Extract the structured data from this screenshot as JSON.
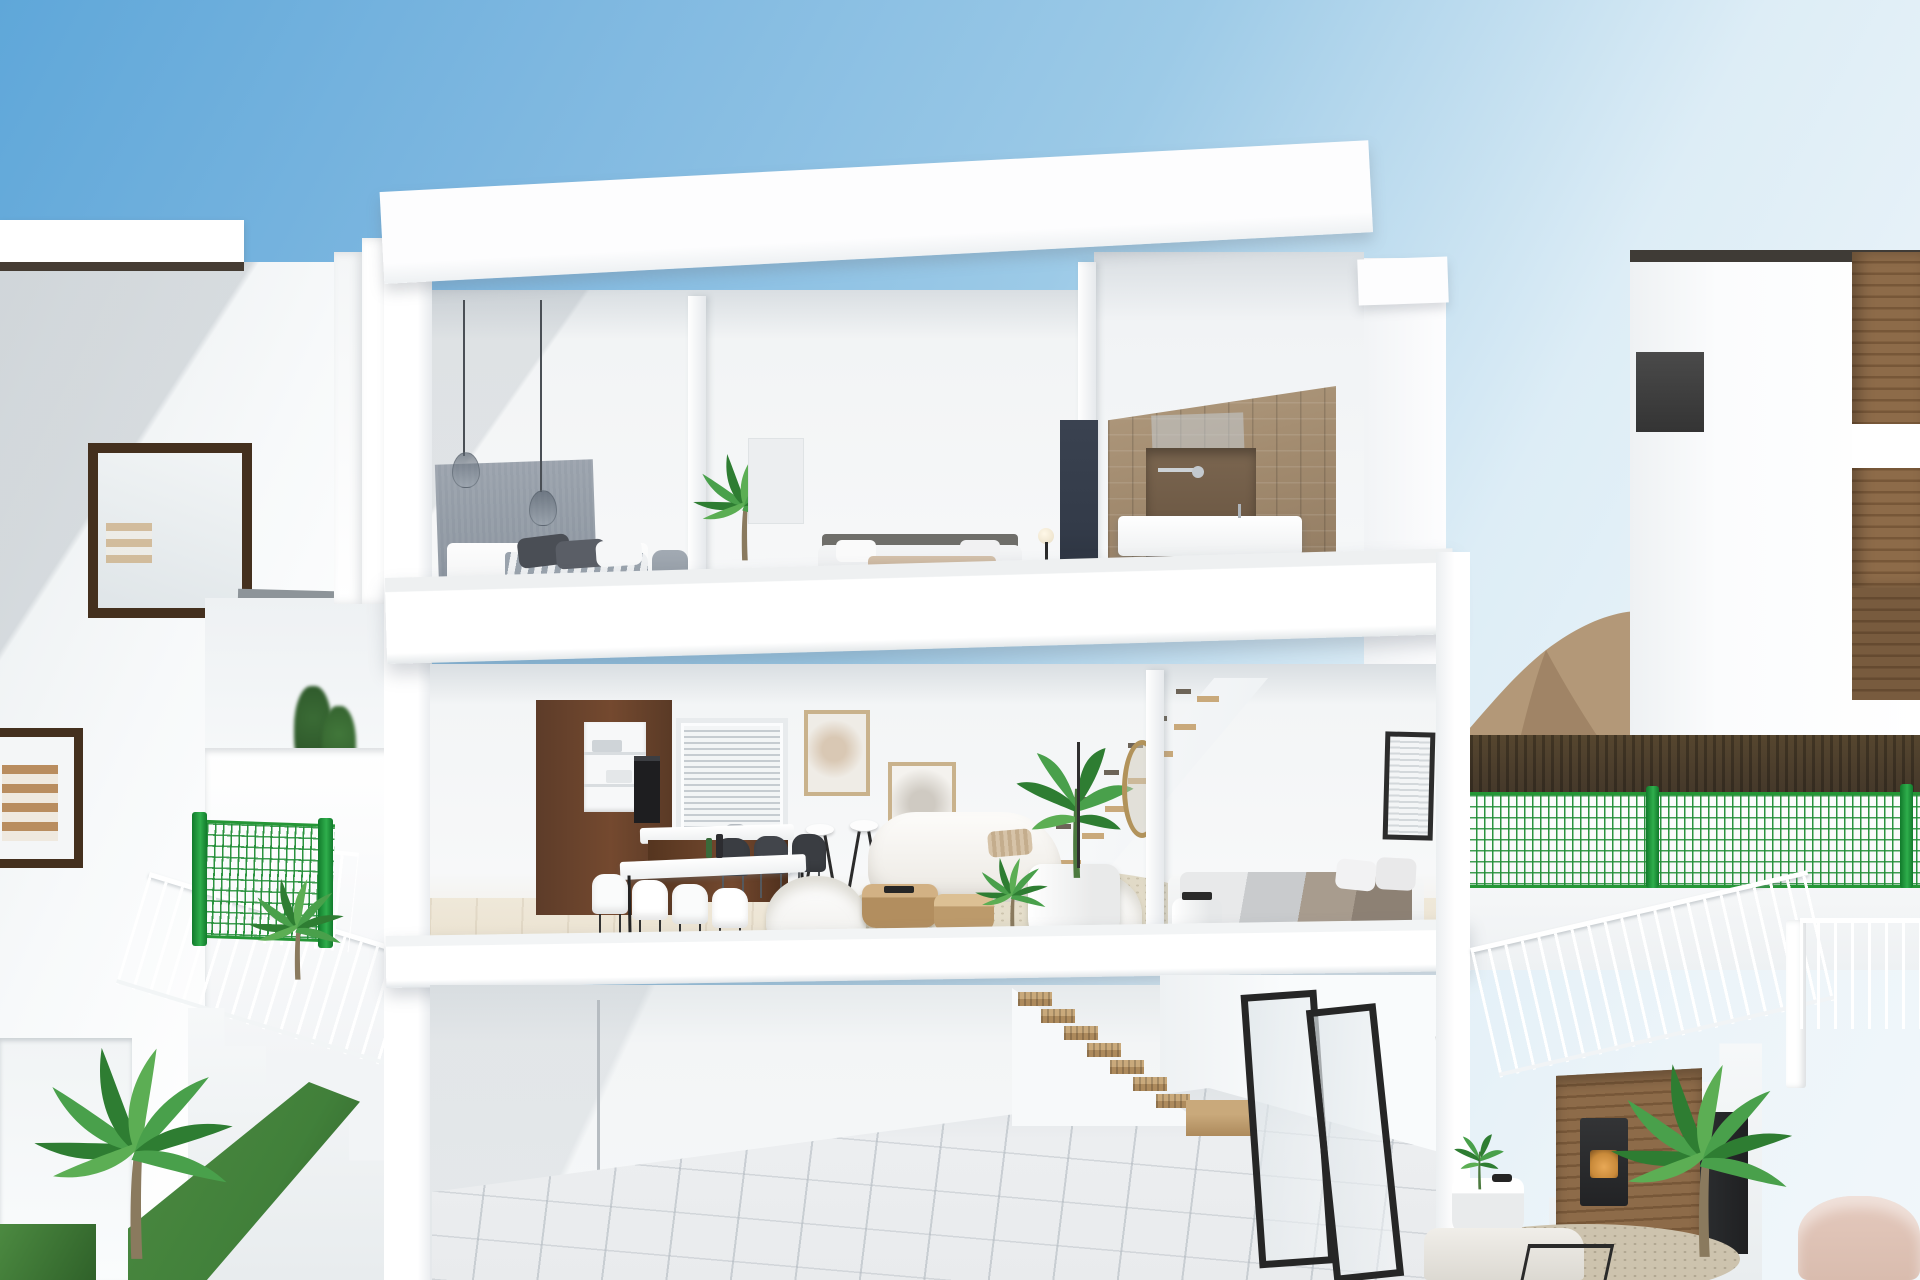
{
  "image": {
    "width": 1920,
    "height": 1280,
    "kind": "3D architectural render, no visible text"
  },
  "scene": {
    "subject": "Cutaway cross-section rendering of a modern three-storey white villa between two neighbouring white houses under a clear blue sky",
    "sky": "clear blue, deepest at upper left, paling toward the horizon",
    "background_elements": [
      "rocky tan mountain slope with green scrub at the right horizon",
      "dark hedge line below the mountains",
      "neighbouring white villa at left with dark-framed windows and interior stair visible",
      "neighbouring white villa at right with dark timber cladding tower and chimney"
    ],
    "floors": [
      {
        "name": "top floor",
        "rooms": [
          "bedroom with grey fabric headboard wall, two glass pendant lamps and striped duvet bed",
          "second bedroom with low bed, beige foot bench, globe floor lamp and tall indoor palm",
          "bathroom with tan stone tiling, dark walk-in shower, chrome fittings, white vanity and navy partition panel"
        ]
      },
      {
        "name": "main floor",
        "rooms": [
          "kitchen with dark walnut cabinetry, white shelf niches, built-in oven, window with venetian blinds and island with bar stools",
          "dining area with white table, white shell chairs and black shell chairs",
          "living room with curved white sofa, two white barrel armchairs, round timber coffee tables, circular beige rug, potted banana plant, gold oval mirror and slim floor lamp",
          "open staircase with floating timber treads rising along the wall",
          "rear bedroom with grey and taupe layered bedding, white laundry cylinder and small blinded window"
        ]
      },
      {
        "name": "basement garage",
        "rooms": [
          "large open space with pale tiled floor",
          "timber staircase with landing block",
          "black-framed glass doors along the rear wall"
        ]
      }
    ],
    "exterior_elements": [
      "green wire-mesh garden fences with round green posts",
      "white outdoor staircases with slender white balustrades on both sides",
      "palm plants, ornamental grass strips and small dark shrubs",
      "outdoor lounge with timber slat wall, black stove with amber glow, tall dark cabinet, round white side table, pale sofa and blush armchair"
    ]
  },
  "colors": {
    "sky1": "#5fa7d9",
    "sky2": "#9ccae7",
    "sky3": "#ddedf6",
    "white": "#ffffff",
    "shade1": "#f4f6f7",
    "shade2": "#e9edef",
    "shade3": "#d9dee2",
    "shade4": "#c6cdd3",
    "walnut1": "#5d3c29",
    "walnut2": "#74492f",
    "walnutDark": "#3f2818",
    "navy": "#333b49",
    "tileTan": "#a18a6e",
    "showerBrown": "#6e593f",
    "gold": "#b2935b",
    "headGrey": "#89929d",
    "pillowDark": "#4a4e55",
    "chairDark": "#3a3d42",
    "woodLight": "#c9a97b",
    "woodMid": "#ad8a5c",
    "rugBeige": "#ded7c4",
    "floorWood": "#efe8d9",
    "tileFloor": "#e9ebed",
    "green1": "#2e7d32",
    "green2": "#49a04b",
    "green3": "#5cae54",
    "fenceGreen": "#259636",
    "fencePost": "#117a2b",
    "grass": "#41803a",
    "mountain1": "#b39878",
    "mountain2": "#8f7557",
    "mountainGreen": "#6d7d4f",
    "hedge": "#44382a",
    "frameBrown": "#44301e",
    "black": "#262626",
    "slat1": "#8d6b49",
    "slat2": "#775738",
    "pink": "#d9bcae",
    "glowAmber": "#c98a3a",
    "trunk": "#8a7a5e"
  }
}
